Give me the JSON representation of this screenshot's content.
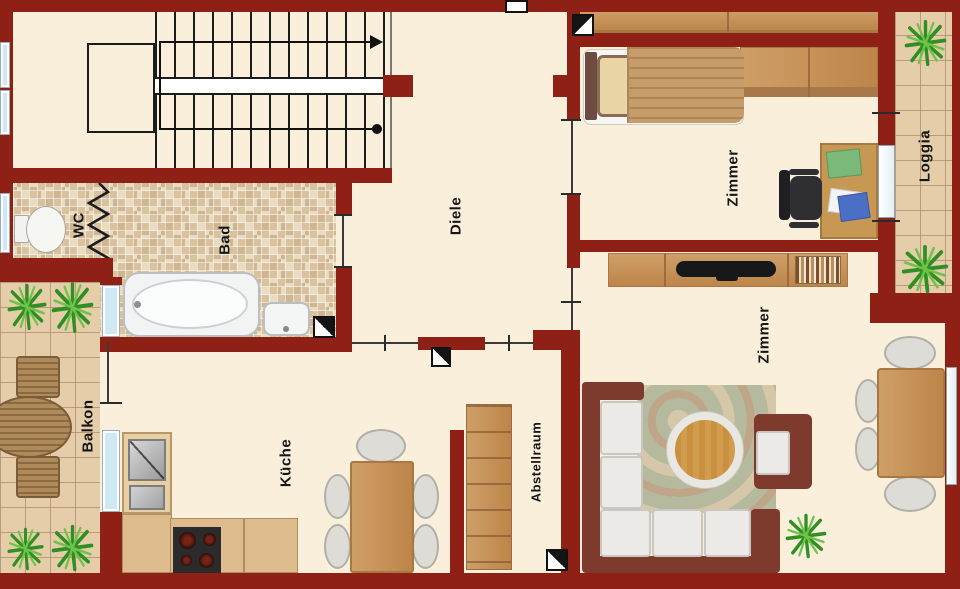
{
  "rooms": {
    "wc": "WC",
    "bad": "Bad",
    "diele": "Diele",
    "zimmer_top": "Zimmer",
    "loggia": "Loggia",
    "zimmer_bottom": "Zimmer",
    "balkon": "Balkon",
    "kueche": "Küche",
    "abstellraum": "Abstellraum"
  },
  "colors": {
    "wall": "#8e2015",
    "floor": "#f9efdb",
    "bath_tile": "#e9dcc2",
    "terrace_tile": "#e4cda8",
    "wood": "#c79754",
    "sofa_frame": "#7e3a2d",
    "plant_green": "#2f8f22",
    "window_glass": "#cfe9f4"
  },
  "icons": {
    "stair_direction": "arrow-right",
    "stair_start": "dot",
    "door_marker": "diagonal-split-square",
    "radiator_symbol": "zigzag"
  }
}
